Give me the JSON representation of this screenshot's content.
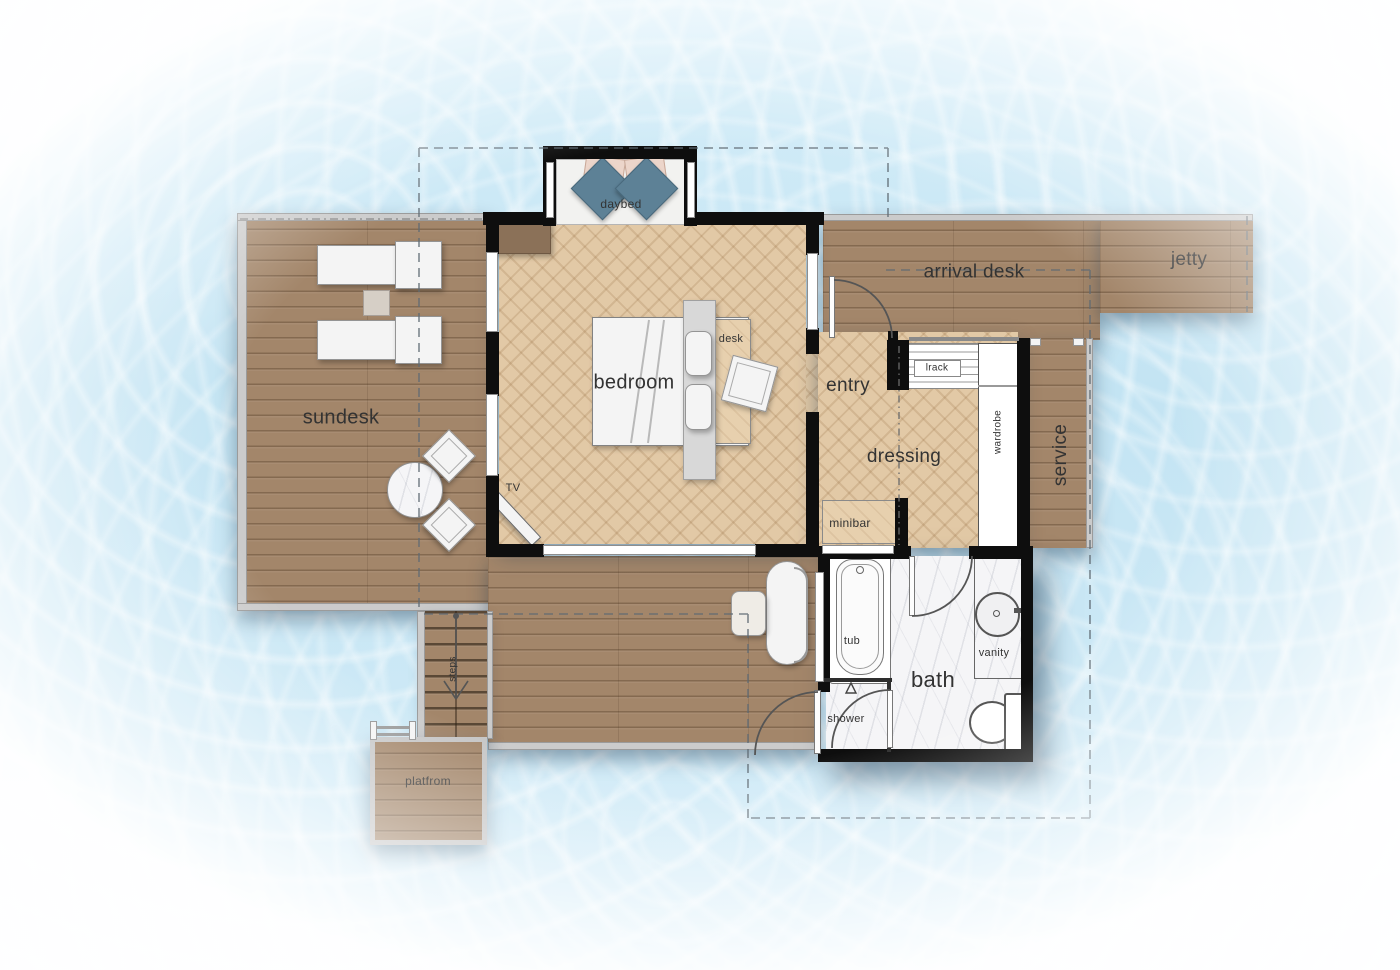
{
  "labels": {
    "daybed": "daybed",
    "arrival_desk": "arrival desk",
    "jetty": "jetty",
    "sundesk": "sundesk",
    "bedroom": "bedroom",
    "desk": "desk",
    "entry": "entry",
    "dressing": "dressing",
    "lrack": "lrack",
    "wardrobe": "wardrobe",
    "service": "service",
    "minibar": "minibar",
    "tv": "TV",
    "tub": "tub",
    "bath": "bath",
    "vanity": "vanity",
    "shower": "shower",
    "steps": "steps",
    "platform": "platfrom"
  },
  "colors": {
    "water": "#c9e6f4",
    "deck_wood": "#a3866a",
    "parquet": "#e2c9a6",
    "light_wood": "#e7d0ae",
    "wall": "#0e0e0e",
    "marble": "#f5f5f7",
    "pillow_teal": "#5d8196",
    "pillow_blush": "#ecd5ca",
    "furniture_white": "#f4f4f4",
    "dash_line": "#5f6a73"
  }
}
